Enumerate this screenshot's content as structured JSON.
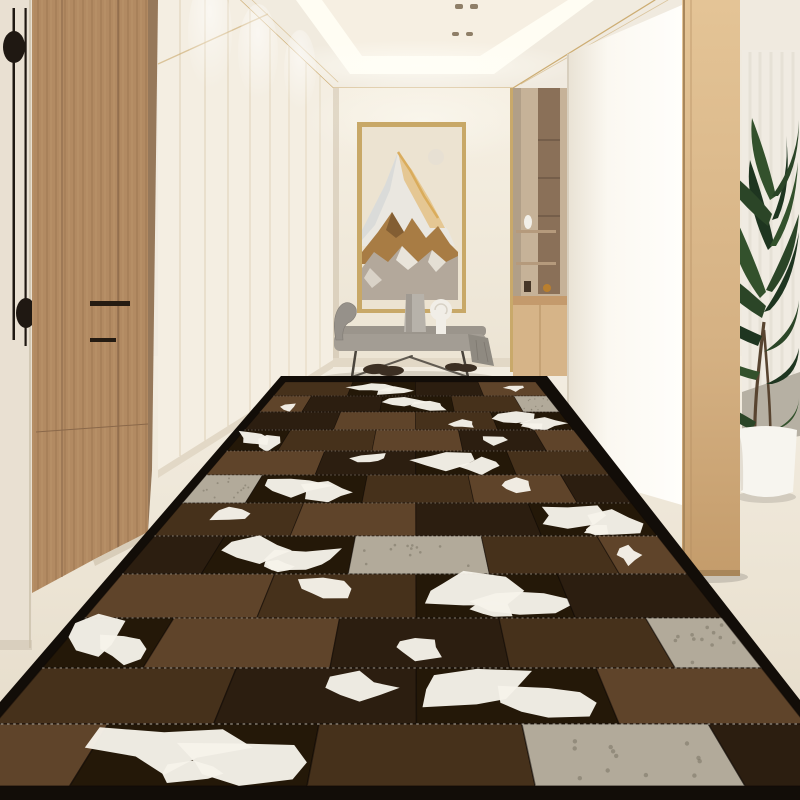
{
  "scene": {
    "label": "Entry hallway with cowhide patchwork runner rug"
  },
  "colors": {
    "bg": "#f0eadf",
    "ceiling_rim": "#f1ebdf",
    "ceiling_glow": "#fffdf3",
    "ceiling_panel": "#f6efe2",
    "gold_trim": "#cdad73",
    "spotlight": "#8f7f68",
    "left_stile": "#e9e0d2",
    "handle_black": "#1f1812",
    "wood_side": "#96785a",
    "white_wall_seam": "#d7c7a6",
    "end_wall": "#f2ecdf",
    "baseboard": "#e2d8c6",
    "corner_shadow": "#b9a88f",
    "niche_trim": "#c9a96a",
    "niche_tan": "#c6b298",
    "niche_wood": "#8a7058",
    "niche_shelf": "#b59a7c",
    "niche_counter": "#c49a6c",
    "niche_cabinet": "#d6b488",
    "column_white": "#fbf8f1",
    "pillar_edge": "#a8875c",
    "curtain": "#f0ebe2",
    "curtain_stripe": "#e3ddd1",
    "side_rug_grey": "#b6b0a3",
    "plant_green": "#2b4527",
    "plant_dark": "#1e3520",
    "plant_mid": "#33512c",
    "trunk": "#584430",
    "pot_white": "#f7f5ef",
    "frame_gold": "#c8a867",
    "art_bg": "#ece3d1",
    "art_moon": "#e7e0d3",
    "art_snow": "#eae7e0",
    "art_shade": "#cfd4d4",
    "art_gold": "#d8a855",
    "art_warm": "#e4bf7f",
    "art_amber": "#a87c44",
    "art_amber_dark": "#7d5930",
    "art_grey": "#b3a89b",
    "art_grey_light": "#e9e4da",
    "bench_seat": "#a39d94",
    "bench_blanket": "#9b958c",
    "bench_arm": "#96918a",
    "bench_drape": "#8f8a81",
    "bench_leg": "#4a443c",
    "vase_grey": "#b7b2aa",
    "towel_white": "#f1eee7",
    "shoe_dark": "#3c2f23"
  },
  "rug": {
    "border_color": "#120d08",
    "silhouette": "281,376 547,376 800,700 800,800 0,800 0,702",
    "back": {
      "y": 380,
      "xl": 287,
      "xr": 534
    },
    "slope_left": -0.85,
    "slope_right": 0.79,
    "row_ys": [
      382,
      396,
      412,
      430,
      451,
      475,
      503,
      536,
      574,
      618,
      668,
      724,
      786
    ],
    "frames": {
      "even": [
        0,
        0.27,
        0.52,
        0.77,
        1
      ],
      "odd": [
        0,
        0.14,
        0.4,
        0.65,
        0.88,
        1
      ]
    },
    "palette": {
      "d": "#2c1e10",
      "b": "#46311b",
      "m": "#5f442a",
      "l": "#73553a",
      "g": "#b2aa9a",
      "W": "#241808"
    },
    "white": "#f6f3ea",
    "speckle": "#7a7264",
    "stitch": "#e8e2d4",
    "rows": [
      [
        "b",
        "W",
        "d",
        "m*"
      ],
      [
        "m*",
        "d",
        "W",
        "b",
        "g"
      ],
      [
        "d",
        "m",
        "b*",
        "W"
      ],
      [
        "W",
        "b",
        "m",
        "d*",
        "m"
      ],
      [
        "m",
        "d*",
        "W",
        "b"
      ],
      [
        "g",
        "W",
        "b",
        "m*",
        "d"
      ],
      [
        "b*",
        "m",
        "d",
        "W"
      ],
      [
        "d",
        "W",
        "g",
        "b",
        "m*"
      ],
      [
        "m",
        "b*",
        "W",
        "d"
      ],
      [
        "W",
        "m",
        "d*",
        "b",
        "g"
      ],
      [
        "b",
        "d*",
        "W",
        "m"
      ],
      [
        "m",
        "W",
        "b",
        "g",
        "d"
      ]
    ]
  }
}
